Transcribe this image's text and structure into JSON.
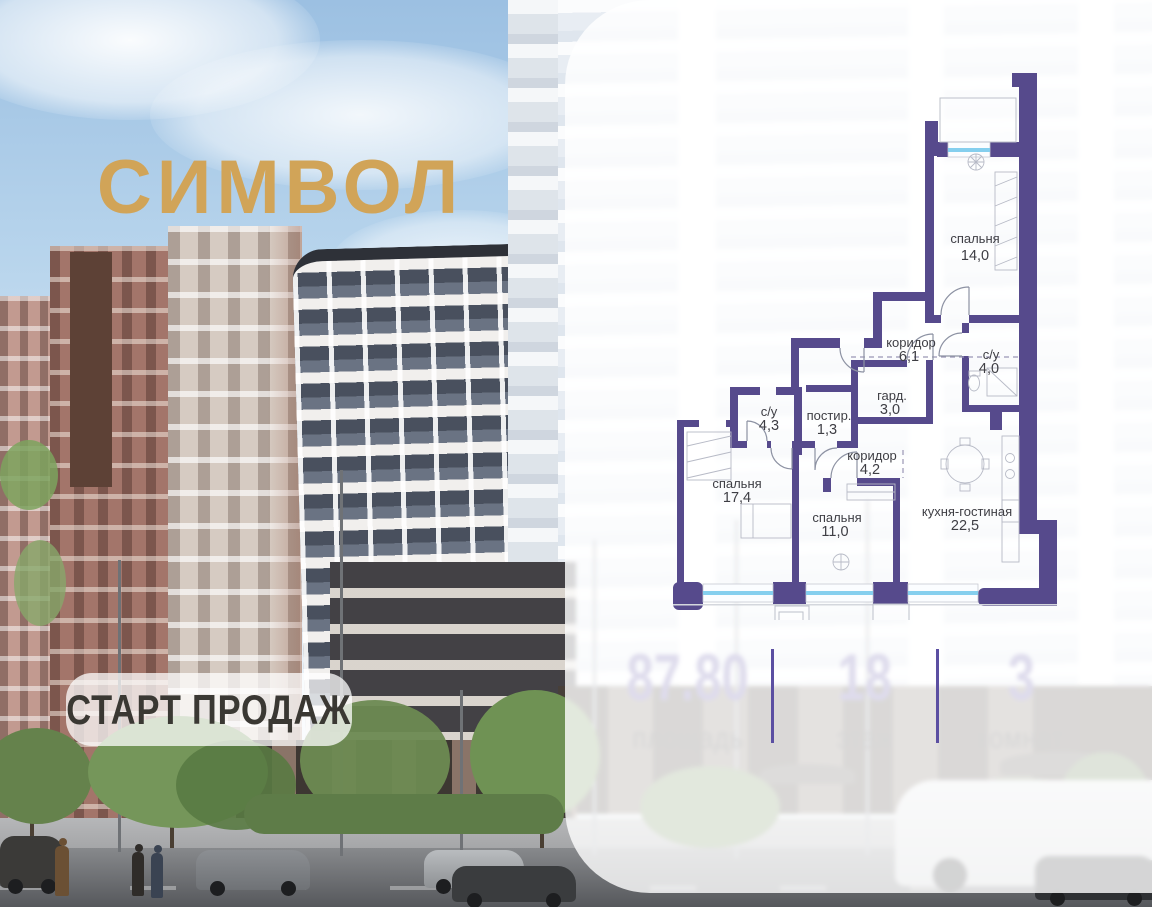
{
  "logo": {
    "text": "СИМВОЛ"
  },
  "sale_badge": {
    "label": "СТАРТ ПРОДАЖ"
  },
  "floor_plan": {
    "rooms": [
      {
        "name": "спальня",
        "area": "14,0"
      },
      {
        "name": "коридор",
        "area": "6,1"
      },
      {
        "name": "с/у",
        "area": "4,0"
      },
      {
        "name": "гард.",
        "area": "3,0"
      },
      {
        "name": "постир.",
        "area": "1,3"
      },
      {
        "name": "с/у",
        "area": "4,3"
      },
      {
        "name": "коридор",
        "area": "4,2"
      },
      {
        "name": "спальня",
        "area": "17,4"
      },
      {
        "name": "спальня",
        "area": "11,0"
      },
      {
        "name": "кухня-гостиная",
        "area": "22,5"
      }
    ],
    "colors": {
      "wall": "#564a8c",
      "window_glass": "#85cfee",
      "furniture_line": "#b7bac6"
    }
  },
  "stats": {
    "items": [
      {
        "value": "87.80",
        "label": "площадь"
      },
      {
        "value": "18",
        "label": "этаж"
      },
      {
        "value": "3",
        "label": "комнат"
      }
    ],
    "accent_color": "#5b4fa2"
  },
  "brand_color_gold": "#d1a458"
}
